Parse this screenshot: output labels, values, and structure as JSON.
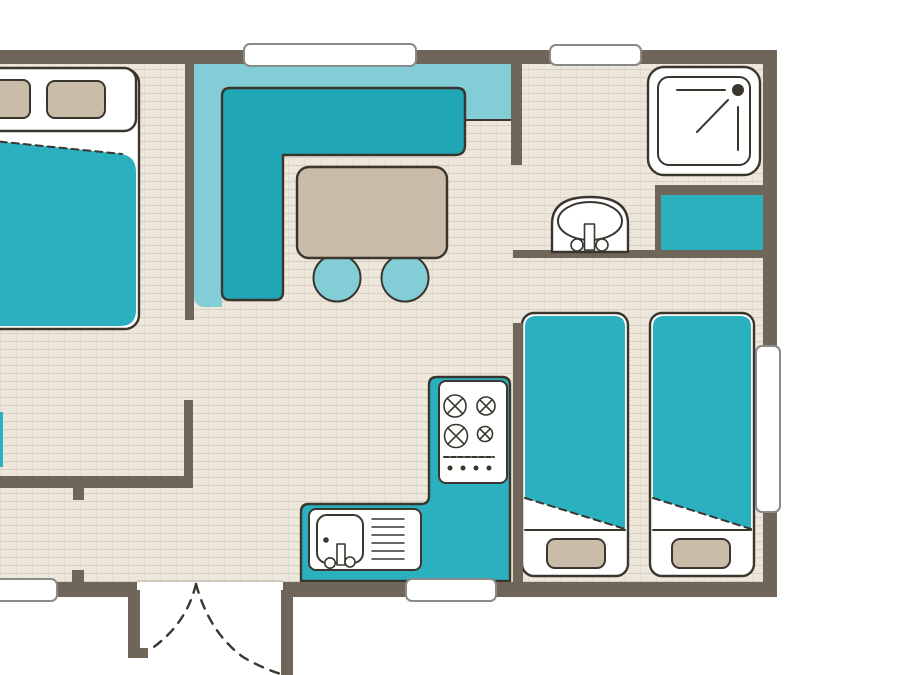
{
  "canvas": {
    "width": 900,
    "height": 675
  },
  "colors": {
    "white": "#ffffff",
    "wall": "#6f6559",
    "floor": "#ece6db",
    "floor_line": "#d8d0c1",
    "outline": "#3a362e",
    "teal": "#2bb0c0",
    "teal_dark": "#21a6b6",
    "teal_light": "#82cdd6",
    "tan": "#c9bca8",
    "window_border": "#8a8a8a",
    "threshold": "#cfc8bb"
  },
  "icons": [
    "double-bed",
    "pillow",
    "single-bed",
    "dining-table",
    "stool",
    "kitchen-worktop",
    "kitchen-counter",
    "stove-hob",
    "sink-unit",
    "shower",
    "washbasin",
    "bathroom-cabinet",
    "window",
    "door-swing",
    "wall"
  ]
}
